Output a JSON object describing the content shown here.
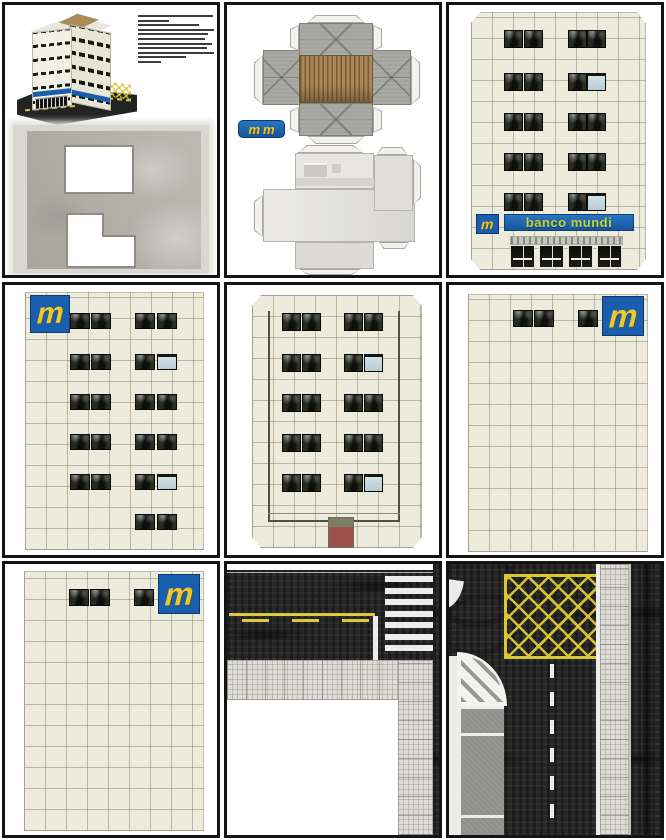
{
  "brand": {
    "logo_letter": "m",
    "sign_text": "banco mundi"
  },
  "colors": {
    "logo_blue": "#1a5fae",
    "logo_yellow": "#eec82b",
    "sign_text": "#c9d230",
    "wall_cream": "#edebdc",
    "window_dark": "#14160f",
    "window_light": "#c6d5dc",
    "asphalt": "#262626",
    "road_yellow": "#ddc93c",
    "sidewalk": "#dedcd6",
    "parking": "#8f8f8b",
    "roof_flap_gray": "#a3a39f",
    "roof_brown": "#ab8758",
    "cut_piece_gray": "#b3b0a8"
  },
  "instructions": {
    "legible": false,
    "line_count": 11
  },
  "walls": {
    "front": {
      "rows": [
        [
          "d",
          "d",
          "d",
          "d"
        ],
        [
          "d",
          "d",
          "d",
          "l"
        ],
        [
          "d",
          "d",
          "d",
          "d"
        ],
        [
          "d",
          "d",
          "d",
          "d"
        ],
        [
          "d",
          "d",
          "d",
          "l"
        ]
      ]
    },
    "side": {
      "rows": [
        [
          "d",
          "d",
          "d",
          "d"
        ],
        [
          "d",
          "d",
          "d",
          "l"
        ],
        [
          "d",
          "d",
          "d",
          "d"
        ],
        [
          "d",
          "d",
          "d",
          "d"
        ],
        [
          "d",
          "d",
          "d",
          "l"
        ],
        [
          null,
          null,
          "d",
          "d"
        ]
      ]
    },
    "rear": {
      "rows": [
        [
          "d",
          "d",
          "d",
          "d"
        ],
        [
          "d",
          "d",
          "d",
          "l"
        ],
        [
          "d",
          "d",
          "d",
          "d"
        ],
        [
          "d",
          "d",
          "d",
          "d"
        ],
        [
          "d",
          "d",
          "d",
          "l"
        ]
      ]
    },
    "blank_right": {
      "rows": [
        [
          "d",
          "d",
          null,
          "d"
        ]
      ]
    },
    "blank_bottom": {
      "rows": [
        [
          "d",
          "d",
          null,
          "d"
        ]
      ]
    }
  },
  "entrance": {
    "door_count": 4
  },
  "roads": {
    "corner": {
      "crosswalk_stripe_count": 7,
      "center_dash_count": 3,
      "has_stop_line": true
    },
    "intersection": {
      "lane_dash_count": 6,
      "parking_divider_count": 2,
      "has_box_junction": true
    }
  }
}
